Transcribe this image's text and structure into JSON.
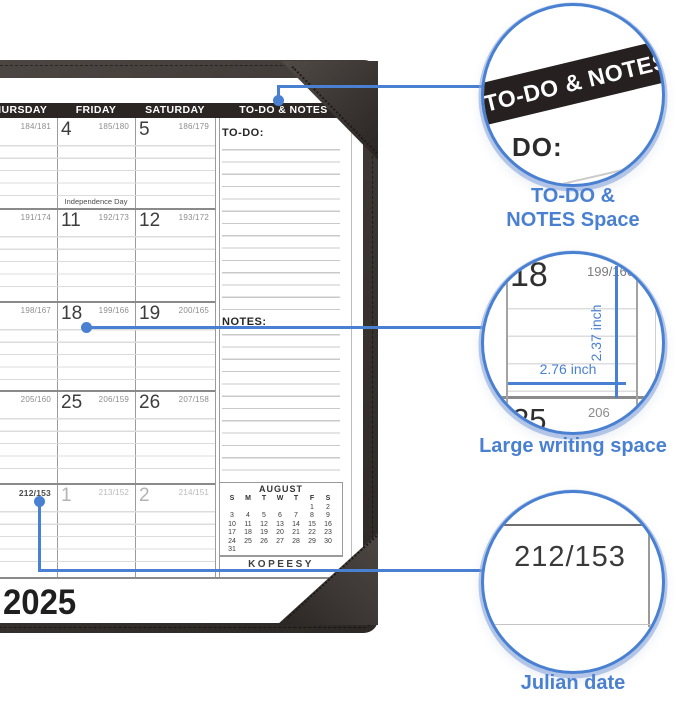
{
  "colors": {
    "accent_blue": "#4a80d2",
    "leather": "#3b3633",
    "header_band": "#2b2623",
    "paper": "#ffffff"
  },
  "calendar": {
    "header": [
      "THURSDAY",
      "FRIDAY",
      "SATURDAY",
      "TO-DO & NOTES"
    ],
    "todo_label": "TO-DO:",
    "notes_label": "NOTES:",
    "holiday": "Independence Day",
    "brand": "KOPEESY",
    "year": "2025",
    "rows": [
      {
        "cells": [
          {
            "day": "",
            "julian": "184/181"
          },
          {
            "day": "4",
            "julian": "185/180"
          },
          {
            "day": "5",
            "julian": "186/179"
          }
        ]
      },
      {
        "cells": [
          {
            "day": "",
            "julian": "191/174"
          },
          {
            "day": "11",
            "julian": "192/173"
          },
          {
            "day": "12",
            "julian": "193/172"
          }
        ]
      },
      {
        "cells": [
          {
            "day": "",
            "julian": "198/167"
          },
          {
            "day": "18",
            "julian": "199/166"
          },
          {
            "day": "19",
            "julian": "200/165"
          }
        ]
      },
      {
        "cells": [
          {
            "day": "",
            "julian": "205/160"
          },
          {
            "day": "25",
            "julian": "206/159"
          },
          {
            "day": "26",
            "julian": "207/158"
          }
        ]
      },
      {
        "cells": [
          {
            "day": "",
            "julian": "212/153"
          },
          {
            "day": "1",
            "julian": "213/152"
          },
          {
            "day": "2",
            "julian": "214/151"
          }
        ]
      }
    ],
    "mini_calendar": {
      "title": "AUGUST",
      "weekdays": [
        "S",
        "M",
        "T",
        "W",
        "T",
        "F",
        "S"
      ],
      "weeks": [
        [
          "",
          "",
          "",
          "",
          "",
          "1",
          "2"
        ],
        [
          "3",
          "4",
          "5",
          "6",
          "7",
          "8",
          "9"
        ],
        [
          "10",
          "11",
          "12",
          "13",
          "14",
          "15",
          "16"
        ],
        [
          "17",
          "18",
          "19",
          "20",
          "21",
          "22",
          "23"
        ],
        [
          "24",
          "25",
          "26",
          "27",
          "28",
          "29",
          "30"
        ],
        [
          "31",
          "",
          "",
          "",
          "",
          "",
          ""
        ]
      ]
    }
  },
  "callouts": {
    "top": {
      "banner": "TO-DO & NOTES",
      "partial_text": "DO:",
      "caption_line1": "TO-DO &",
      "caption_line2": "NOTES Space"
    },
    "middle": {
      "day": "18",
      "julian": "199/166",
      "v_measure": "2.37 inch",
      "h_measure": "2.76 inch",
      "next_day": "25",
      "next_julian": "206",
      "caption": "Large writing space"
    },
    "bottom": {
      "julian": "212/153",
      "caption": "Julian date"
    }
  }
}
